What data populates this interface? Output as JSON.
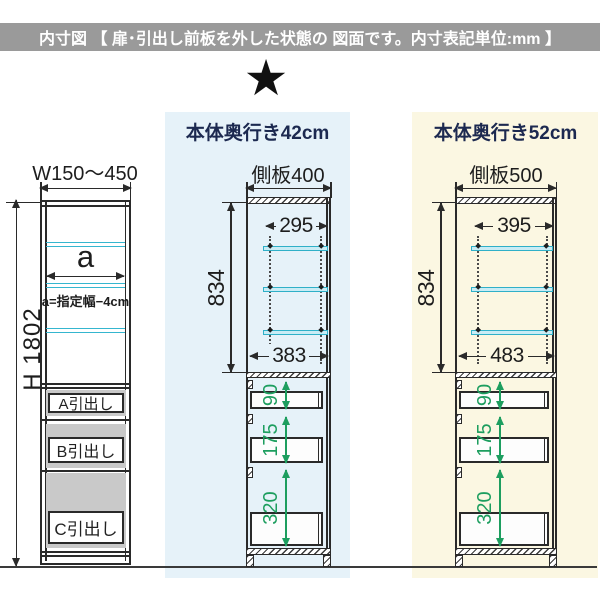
{
  "header": {
    "title": "内寸図 【 扉･引出し前板を外した状態の  図面です。内寸表記単位:mm 】",
    "bg": "#9a9a9a"
  },
  "star": {
    "glyph": "★"
  },
  "columns": {
    "depth42": {
      "label": "本体奥行き42cm",
      "bg": "#e6f2f9",
      "text_color": "#1c2950"
    },
    "depth52": {
      "label": "本体奥行き52cm",
      "bg": "#fbf7e2",
      "text_color": "#1c2950"
    }
  },
  "front_view": {
    "width_label": "W150〜450",
    "height_label": "H 1802",
    "shelf_width_label": "a",
    "shelf_note": "a=指定幅−4cm",
    "drawers": [
      {
        "label": "A引出し"
      },
      {
        "label": "B引出し"
      },
      {
        "label": "C引出し"
      }
    ]
  },
  "side_view_42": {
    "panel_label": "側板400",
    "shelf_width": "295",
    "shelf_zone_height": "834",
    "inner_width": "383",
    "drawer_heights": [
      "90",
      "175",
      "320"
    ]
  },
  "side_view_52": {
    "panel_label": "側板500",
    "shelf_width": "395",
    "shelf_zone_height": "834",
    "inner_width": "483",
    "drawer_heights": [
      "90",
      "175",
      "320"
    ]
  },
  "colors": {
    "line": "#2a2a2a",
    "shelf_cyan": "#35b6cf",
    "dim_green": "#1d9e5f",
    "gray_band": "#c9c9c9",
    "ground": "#3a3a3a"
  }
}
